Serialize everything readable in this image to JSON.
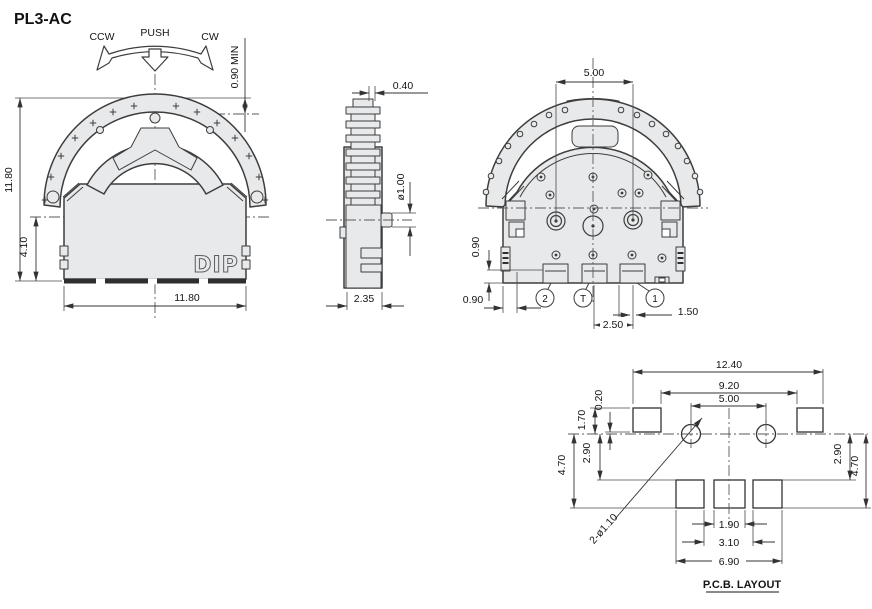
{
  "title": "PL3-AC",
  "front_view": {
    "rotate_ccw": "CCW",
    "push": "PUSH",
    "rotate_cw": "CW",
    "dim_knob_protrusion": "0.90 MIN",
    "dim_total_height": "11.80",
    "dim_body_height": "4.10",
    "dim_total_width": "11.80",
    "marking": "DIP"
  },
  "side_view": {
    "dim_knob_tip": "0.40",
    "dim_shaft_dia": "ø1.00",
    "dim_depth": "2.35"
  },
  "back_view": {
    "dim_knob_width": "5.00",
    "dim_terminal_height": "0.90",
    "dim_edge_offset": "0.90",
    "dim_terminal_pitch": "2.50",
    "dim_terminal_width": "1.50",
    "terminal_2": "2",
    "terminal_t": "T",
    "terminal_1": "1"
  },
  "pcb": {
    "caption": "P.C.B. LAYOUT",
    "dim_overall_width": "12.40",
    "dim_pad_span": "9.20",
    "dim_hole_pitch": "5.00",
    "dim_pad_offset": "0.20",
    "dim_pad_height": "1.70",
    "dim_mid_left": "2.90",
    "dim_total_left": "4.70",
    "dim_mid_right": "2.90",
    "dim_total_right": "4.70",
    "hole_callout": "2-ø1.10",
    "dim_slot_width": "1.90",
    "dim_slot_span": "3.10",
    "dim_slot_overall": "6.90"
  },
  "colors": {
    "line": "#3d3d3d",
    "fill": "#e8e9ea",
    "background": "#ffffff"
  }
}
